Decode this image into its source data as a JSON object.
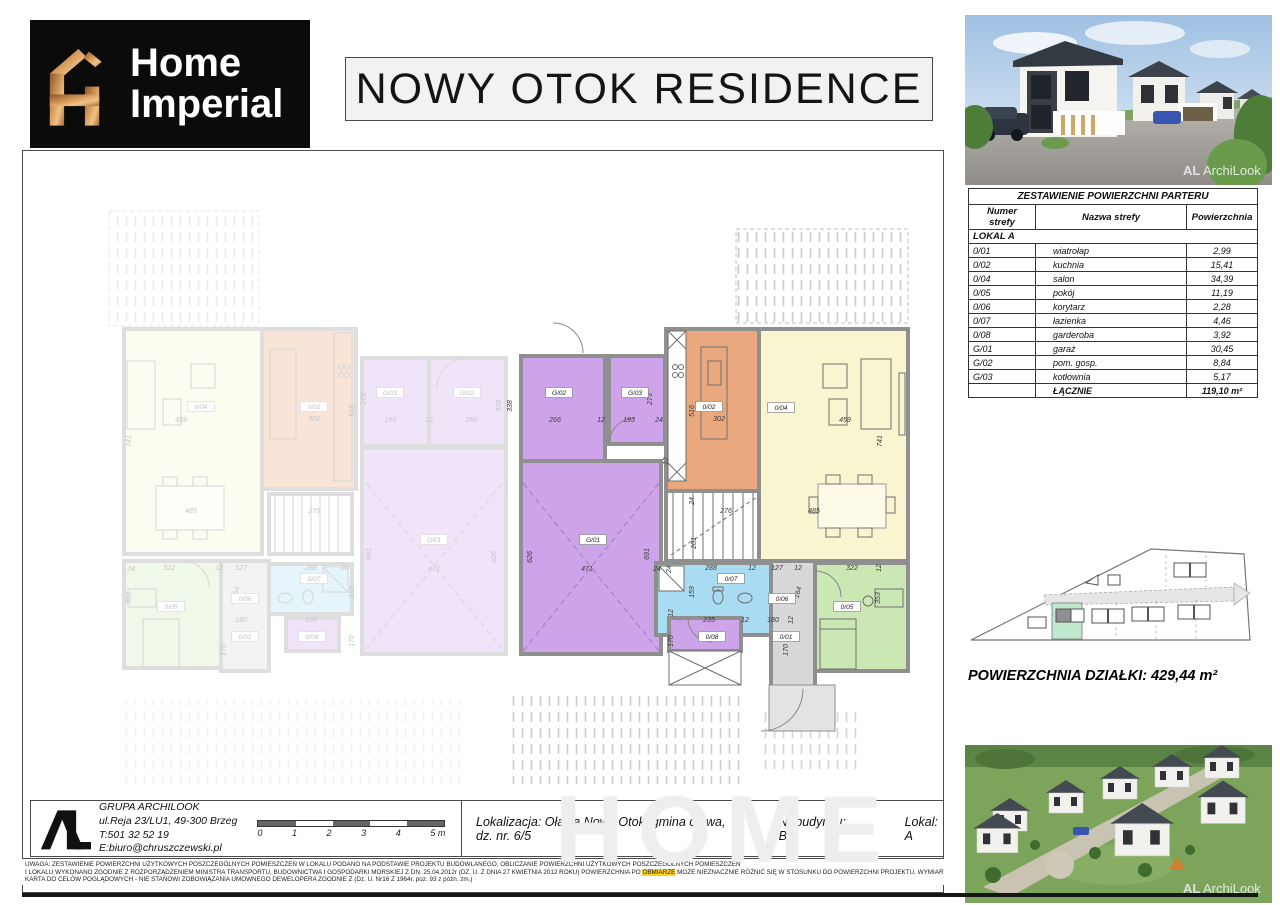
{
  "header": {
    "brand_line1": "Home",
    "brand_line2": "Imperial",
    "title": "NOWY OTOK RESIDENCE"
  },
  "renders": {
    "watermark_logo": "AL",
    "watermark_text": "ArchiLook"
  },
  "area_table": {
    "title": "ZESTAWIENIE POWIERZCHNI PARTERU",
    "columns": [
      "Numer strefy",
      "Nazwa strefy",
      "Powierzchnia"
    ],
    "group": "LOKAL A",
    "rows": [
      {
        "num": "0/01",
        "name": "wiatrołap",
        "area": "2,99"
      },
      {
        "num": "0/02",
        "name": "kuchnia",
        "area": "15,41"
      },
      {
        "num": "0/04",
        "name": "salon",
        "area": "34,39"
      },
      {
        "num": "0/05",
        "name": "pokój",
        "area": "11,19"
      },
      {
        "num": "0/06",
        "name": "korytarz",
        "area": "2,28"
      },
      {
        "num": "0/07",
        "name": "łazienka",
        "area": "4,46"
      },
      {
        "num": "0/08",
        "name": "garderoba",
        "area": "3,92"
      },
      {
        "num": "G/01",
        "name": "garaż",
        "area": "30,45"
      },
      {
        "num": "G/02",
        "name": "pom. gosp.",
        "area": "8,84"
      },
      {
        "num": "G/03",
        "name": "kotłownia",
        "area": "5,17"
      }
    ],
    "total_label": "ŁĄCZNIE",
    "total_value": "119,10 m²"
  },
  "site_plan": {
    "area_label": "POWIERZCHNIA DZIAŁKI: 429,44 m²",
    "highlight_color": "#bfe8cf"
  },
  "footer": {
    "company": {
      "name": "GRUPA ARCHILOOK",
      "address": "ul.Reja 23/LU1, 49-300 Brzeg",
      "phone": "T:501 32 52 19",
      "email": "E:biuro@chruszczewski.pl"
    },
    "scale_labels": [
      "0",
      "1",
      "2",
      "3",
      "4",
      "5 m"
    ],
    "location": "Lokalizacja: Oława Nowy Otok, gmina oława, dz. nr. 6/5",
    "building": "Nr budynku: B3",
    "unit": "Lokal: A",
    "disclaimer_line1": "UWAGA: ZESTAWIENIE POWIERZCHNI UŻYTKOWYCH POSZCZEGÓLNYCH POMIESZCZEŃ W LOKALU PODANO NA PODSTAWIE PROJEKTU BUDOWLANEGO, OBLICZANIE POWIERZCHNI UŻYTKOWYCH POSZCZEGÓLNYCH POMIESZCZEŃ",
    "disclaimer_line2_pre": "I LOKALU WYKONANO ZGODNIE Z ROZPORZĄDZENIEM MINISTRA TRANSPORTU, BUDOWNICTWA I GOSPODARKI MORSKIEJ Z DN. 25.04.2012r (DZ. U. Z DNIA 27 KWIETNIA 2012 ROKU) POWIERZCHNIA PO ",
    "disclaimer_line2_hl": "OBMIARZE",
    "disclaimer_line2_post": " MOŻE NIEZNACZNIE RÓŻNIĆ SIĘ W STOSUNKU DO POWIERZCHNI PROJEKTU. WYMIARY ZOSTAŁY PODANE BEZ GRUBOŚCI TYNKÓW.",
    "disclaimer_line3": "KARTA DO CELÓW POGLĄDOWYCH - NIE STANOWI ZOBOWIĄZANIA UMOWNEGO DEWELOPERA ZGODNIE Z (Dz. U. Nr16 Z 1964r. poz. 93 z późn. zm.)",
    "watermark": "HOME"
  },
  "floor_plan": {
    "palette": {
      "wall": "#8f8f8f",
      "purple": "#cda4ea",
      "orange": "#e9a87e",
      "yellow": "#f8f5d0",
      "blue": "#a9dcf2",
      "green": "#cbe7b4",
      "corridor": "#d8d8d8"
    },
    "units": [
      {
        "id": "left",
        "rooms": [
          {
            "x": 101,
            "y": 178,
            "w": 138,
            "h": 225,
            "f": "#f8f5d0"
          },
          {
            "x": 239,
            "y": 178,
            "w": 94,
            "h": 160,
            "f": "#e9a87e"
          },
          {
            "x": 339,
            "y": 207,
            "w": 67,
            "h": 88,
            "f": "#cda4ea"
          },
          {
            "x": 406,
            "y": 207,
            "w": 77,
            "h": 88,
            "f": "#cda4ea"
          },
          {
            "x": 339,
            "y": 297,
            "w": 144,
            "h": 206,
            "f": "#cda4ea"
          },
          {
            "x": 246,
            "y": 343,
            "w": 83,
            "h": 60,
            "f": "#ffffff"
          },
          {
            "x": 101,
            "y": 410,
            "w": 97,
            "h": 107,
            "f": "#cbe7b4"
          },
          {
            "x": 198,
            "y": 410,
            "w": 48,
            "h": 110,
            "f": "#d8d8d8"
          },
          {
            "x": 246,
            "y": 413,
            "w": 83,
            "h": 50,
            "f": "#a9dcf2"
          },
          {
            "x": 263,
            "y": 467,
            "w": 53,
            "h": 33,
            "f": "#cda4ea"
          }
        ],
        "labels": [
          {
            "t": "G/03",
            "x": 367,
            "y": 244
          },
          {
            "t": "G/02",
            "x": 444,
            "y": 244
          },
          {
            "t": "0/02",
            "x": 291,
            "y": 258
          },
          {
            "t": "0/04",
            "x": 178,
            "y": 258
          },
          {
            "t": "G/01",
            "x": 411,
            "y": 391
          },
          {
            "t": "0/05",
            "x": 148,
            "y": 458
          },
          {
            "t": "0/06",
            "x": 222,
            "y": 450
          },
          {
            "t": "0/07",
            "x": 291,
            "y": 430
          },
          {
            "t": "0/08",
            "x": 289,
            "y": 488
          },
          {
            "t": "0/01",
            "x": 222,
            "y": 488
          }
        ],
        "dims": [
          {
            "t": "459",
            "x": 158,
            "y": 271
          },
          {
            "t": "302",
            "x": 291,
            "y": 270
          },
          {
            "t": "516",
            "x": 331,
            "y": 260,
            "r": -90
          },
          {
            "t": "741",
            "x": 108,
            "y": 290,
            "r": -90
          },
          {
            "t": "193",
            "x": 367,
            "y": 271
          },
          {
            "t": "12",
            "x": 406,
            "y": 271
          },
          {
            "t": "266",
            "x": 448,
            "y": 271
          },
          {
            "t": "273",
            "x": 343,
            "y": 248,
            "r": -90
          },
          {
            "t": "338",
            "x": 478,
            "y": 255,
            "r": -90
          },
          {
            "t": "485",
            "x": 168,
            "y": 362
          },
          {
            "t": "276",
            "x": 291,
            "y": 362
          },
          {
            "t": "471",
            "x": 411,
            "y": 420
          },
          {
            "t": "691",
            "x": 348,
            "y": 403,
            "r": -90
          },
          {
            "t": "626",
            "x": 473,
            "y": 406,
            "r": -90
          },
          {
            "t": "322",
            "x": 146,
            "y": 419
          },
          {
            "t": "12",
            "x": 196,
            "y": 419
          },
          {
            "t": "127",
            "x": 218,
            "y": 419
          },
          {
            "t": "288",
            "x": 288,
            "y": 419
          },
          {
            "t": "24",
            "x": 322,
            "y": 419
          },
          {
            "t": "353",
            "x": 108,
            "y": 447,
            "r": -90
          },
          {
            "t": "164",
            "x": 215,
            "y": 442,
            "r": -75
          },
          {
            "t": "159",
            "x": 331,
            "y": 441,
            "r": -90
          },
          {
            "t": "235",
            "x": 288,
            "y": 471
          },
          {
            "t": "180",
            "x": 218,
            "y": 471
          },
          {
            "t": "170",
            "x": 331,
            "y": 490,
            "r": -90
          },
          {
            "t": "170",
            "x": 203,
            "y": 499,
            "r": -90
          },
          {
            "t": "24",
            "x": 108,
            "y": 420
          }
        ]
      },
      {
        "id": "right",
        "rooms": [
          {
            "x": 498,
            "y": 205,
            "w": 84,
            "h": 105,
            "f": "#cda4ea"
          },
          {
            "x": 586,
            "y": 205,
            "w": 56,
            "h": 88,
            "f": "#cda4ea"
          },
          {
            "x": 498,
            "y": 310,
            "w": 140,
            "h": 193,
            "f": "#cda4ea"
          },
          {
            "x": 643,
            "y": 178,
            "w": 115,
            "h": 162,
            "f": "#e9a87e"
          },
          {
            "x": 736,
            "y": 178,
            "w": 149,
            "h": 232,
            "f": "#f8f5d0"
          },
          {
            "x": 643,
            "y": 340,
            "w": 93,
            "h": 70,
            "f": "#ffffff"
          },
          {
            "x": 633,
            "y": 412,
            "w": 115,
            "h": 72,
            "f": "#a9dcf2"
          },
          {
            "x": 646,
            "y": 467,
            "w": 72,
            "h": 33,
            "f": "#cda4ea"
          },
          {
            "x": 748,
            "y": 410,
            "w": 44,
            "h": 148,
            "f": "#d8d8d8"
          },
          {
            "x": 792,
            "y": 412,
            "w": 93,
            "h": 108,
            "f": "#cbe7b4"
          }
        ],
        "labels": [
          {
            "t": "G/02",
            "x": 536,
            "y": 244
          },
          {
            "t": "G/03",
            "x": 612,
            "y": 244
          },
          {
            "t": "G/01",
            "x": 570,
            "y": 391
          },
          {
            "t": "0/02",
            "x": 686,
            "y": 258
          },
          {
            "t": "0/04",
            "x": 758,
            "y": 259
          },
          {
            "t": "0/07",
            "x": 708,
            "y": 430
          },
          {
            "t": "0/06",
            "x": 759,
            "y": 450
          },
          {
            "t": "0/05",
            "x": 824,
            "y": 458
          },
          {
            "t": "0/08",
            "x": 689,
            "y": 488
          },
          {
            "t": "0/01",
            "x": 763,
            "y": 488
          }
        ],
        "dims": [
          {
            "t": "338",
            "x": 489,
            "y": 255,
            "r": -90
          },
          {
            "t": "266",
            "x": 532,
            "y": 271
          },
          {
            "t": "12",
            "x": 578,
            "y": 271
          },
          {
            "t": "193",
            "x": 606,
            "y": 271
          },
          {
            "t": "24",
            "x": 636,
            "y": 271
          },
          {
            "t": "273",
            "x": 629,
            "y": 248,
            "r": -90
          },
          {
            "t": "12",
            "x": 645,
            "y": 310,
            "r": -90
          },
          {
            "t": "516",
            "x": 671,
            "y": 260,
            "r": -90
          },
          {
            "t": "302",
            "x": 696,
            "y": 270
          },
          {
            "t": "459",
            "x": 822,
            "y": 271
          },
          {
            "t": "741",
            "x": 859,
            "y": 290,
            "r": -90
          },
          {
            "t": "24",
            "x": 671,
            "y": 350,
            "r": -90
          },
          {
            "t": "276",
            "x": 703,
            "y": 362
          },
          {
            "t": "485",
            "x": 791,
            "y": 362
          },
          {
            "t": "201",
            "x": 673,
            "y": 392,
            "r": -90
          },
          {
            "t": "626",
            "x": 509,
            "y": 406,
            "r": -90
          },
          {
            "t": "471",
            "x": 564,
            "y": 420
          },
          {
            "t": "24",
            "x": 634,
            "y": 420
          },
          {
            "t": "691",
            "x": 626,
            "y": 403,
            "r": -90
          },
          {
            "t": "24",
            "x": 648,
            "y": 418,
            "r": -90
          },
          {
            "t": "288",
            "x": 688,
            "y": 419
          },
          {
            "t": "12",
            "x": 729,
            "y": 419
          },
          {
            "t": "127",
            "x": 754,
            "y": 419
          },
          {
            "t": "12",
            "x": 775,
            "y": 419
          },
          {
            "t": "322",
            "x": 829,
            "y": 419
          },
          {
            "t": "12",
            "x": 858,
            "y": 417,
            "r": -90
          },
          {
            "t": "159",
            "x": 671,
            "y": 441,
            "r": -90
          },
          {
            "t": "164",
            "x": 777,
            "y": 442,
            "r": -75
          },
          {
            "t": "353",
            "x": 857,
            "y": 447,
            "r": -90
          },
          {
            "t": "12",
            "x": 650,
            "y": 462,
            "r": -90
          },
          {
            "t": "235",
            "x": 686,
            "y": 471
          },
          {
            "t": "12",
            "x": 722,
            "y": 471
          },
          {
            "t": "180",
            "x": 750,
            "y": 471
          },
          {
            "t": "12",
            "x": 770,
            "y": 469,
            "r": -90
          },
          {
            "t": "170",
            "x": 650,
            "y": 490,
            "r": -90
          },
          {
            "t": "170",
            "x": 765,
            "y": 499,
            "r": -90
          }
        ]
      }
    ]
  }
}
